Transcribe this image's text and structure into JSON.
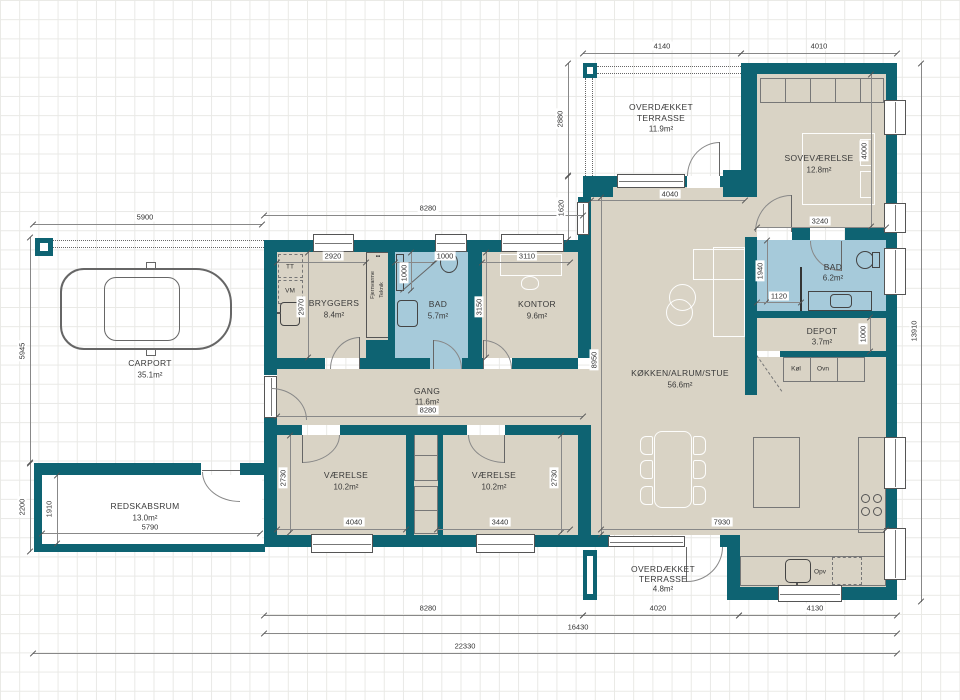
{
  "colors": {
    "wall": "#0e6372",
    "floor": "#d9d3c5",
    "wet": "#a6cada",
    "grid": "#e9e9e6"
  },
  "rooms": {
    "terrace_north": {
      "line1": "OVERDÆKKET",
      "line2": "TERRASSE",
      "area": "11.9m²"
    },
    "bedroom": {
      "name": "SOVEVÆRELSE",
      "area": "12.8m²"
    },
    "bryggers": {
      "name": "BRYGGERS",
      "area": "8.4m²"
    },
    "bath_small": {
      "name": "BAD",
      "area": "5.7m²"
    },
    "office": {
      "name": "KONTOR",
      "area": "9.6m²"
    },
    "bath_ensuite": {
      "name": "BAD",
      "area": "6.2m²"
    },
    "depot": {
      "name": "DEPOT",
      "area": "3.7m²"
    },
    "living": {
      "name": "KØKKEN/ALRUM/STUE",
      "area": "56.6m²"
    },
    "hall": {
      "name": "GANG",
      "area": "11.6m²"
    },
    "room_left": {
      "name": "VÆRELSE",
      "area": "10.2m²"
    },
    "room_right": {
      "name": "VÆRELSE",
      "area": "10.2m²"
    },
    "carport": {
      "name": "CARPORT",
      "area": "35.1m²"
    },
    "shed": {
      "name": "REDSKABSRUM",
      "area": "13.0m²"
    },
    "terrace_south": {
      "line1": "OVERDÆKKET",
      "line2": "TERRASSE",
      "area": "4.8m²"
    }
  },
  "dims": {
    "top_left": "4140",
    "top_right": "4010",
    "terrace_h": "2880",
    "step_h": "1620",
    "carport_w": "5900",
    "carport_h": "5945",
    "shed_outer_h": "2200",
    "shed_inner_h": "1910",
    "shed_inner_w": "5790",
    "row_top": "8280",
    "bryggers_w": "2920",
    "shower_w": "1000",
    "office_w": "3110",
    "bryggers_h": "2970",
    "shower_h": "1000",
    "office_h": "3150",
    "living_top": "4040",
    "bedroom_bottom": "3240",
    "bedroom_h": "4000",
    "bath_h": "1940",
    "bath_w": "1120",
    "depot_h": "1000",
    "living_h": "8950",
    "living_bottom": "7930",
    "hall_w": "8280",
    "room_left_w": "4040",
    "room_right_w": "3440",
    "room_left_h": "2730",
    "room_right_h": "2730",
    "bottom_left": "8280",
    "terrace_s_w": "4020",
    "kitchen_w": "4130",
    "house_total": "16430",
    "site_total": "22330",
    "right_total": "13910"
  },
  "fixtures": {
    "tumble_dryer": "TT",
    "washer": "VM",
    "district_heating": "Fjernvarme",
    "tech": "Teknik",
    "dots": "••",
    "fridge": "Køl",
    "oven": "Ovn",
    "dishwasher": "Opv"
  }
}
